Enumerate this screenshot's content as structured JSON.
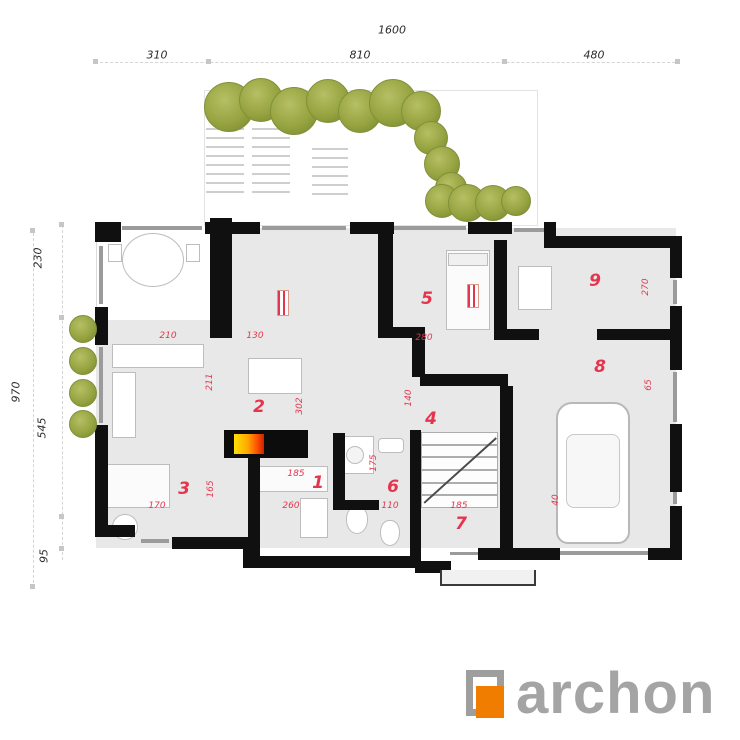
{
  "colors": {
    "floor": "#e8e8e8",
    "wall": "#101010",
    "red": "#e3364e",
    "logo_gray": "#a4a4a4",
    "logo_orange": "#f07d00",
    "green": "#97a441",
    "accent_green": "#5ec81e"
  },
  "logo": {
    "text": "archon"
  },
  "dimensions": {
    "top": [
      {
        "label": "1600",
        "x": 392,
        "y": 30
      },
      {
        "label": "310",
        "x": 157,
        "y": 55
      },
      {
        "label": "810",
        "x": 360,
        "y": 55
      },
      {
        "label": "480",
        "x": 594,
        "y": 55
      }
    ],
    "left": [
      {
        "label": "230",
        "x": 38,
        "y": 258
      },
      {
        "label": "970",
        "x": 16,
        "y": 392
      },
      {
        "label": "545",
        "x": 42,
        "y": 428
      },
      {
        "label": "95",
        "x": 44,
        "y": 556
      }
    ]
  },
  "rooms": [
    {
      "number": "1",
      "x": 318,
      "y": 483
    },
    {
      "number": "2",
      "x": 259,
      "y": 407
    },
    {
      "number": "3",
      "x": 184,
      "y": 489
    },
    {
      "number": "4",
      "x": 431,
      "y": 419
    },
    {
      "number": "5",
      "x": 427,
      "y": 299
    },
    {
      "number": "6",
      "x": 393,
      "y": 487
    },
    {
      "number": "7",
      "x": 461,
      "y": 524
    },
    {
      "number": "8",
      "x": 600,
      "y": 367
    },
    {
      "number": "9",
      "x": 595,
      "y": 281
    }
  ],
  "room_dims": [
    {
      "text": "210",
      "x": 168,
      "y": 336,
      "rot": false
    },
    {
      "text": "130",
      "x": 255,
      "y": 336,
      "rot": false
    },
    {
      "text": "211",
      "x": 210,
      "y": 382,
      "rot": true
    },
    {
      "text": "302",
      "x": 300,
      "y": 406,
      "rot": true
    },
    {
      "text": "170",
      "x": 157,
      "y": 506,
      "rot": false
    },
    {
      "text": "165",
      "x": 211,
      "y": 489,
      "rot": true
    },
    {
      "text": "185",
      "x": 296,
      "y": 474,
      "rot": false
    },
    {
      "text": "260",
      "x": 291,
      "y": 506,
      "rot": false
    },
    {
      "text": "140",
      "x": 409,
      "y": 398,
      "rot": true
    },
    {
      "text": "280",
      "x": 424,
      "y": 338,
      "rot": false
    },
    {
      "text": "110",
      "x": 390,
      "y": 506,
      "rot": false
    },
    {
      "text": "185",
      "x": 459,
      "y": 506,
      "rot": false
    },
    {
      "text": "175",
      "x": 374,
      "y": 463,
      "rot": true
    },
    {
      "text": "65",
      "x": 649,
      "y": 385,
      "rot": true
    },
    {
      "text": "270",
      "x": 646,
      "y": 287,
      "rot": true
    },
    {
      "text": "40",
      "x": 556,
      "y": 500,
      "rot": true
    }
  ],
  "geometry": {
    "floor": [
      [
        96,
        228,
        580,
        320
      ]
    ],
    "terrace": [
      [
        96,
        228,
        114,
        92
      ]
    ],
    "walls": [
      [
        95,
        222,
        26,
        20
      ],
      [
        205,
        222,
        55,
        12
      ],
      [
        350,
        222,
        44,
        12
      ],
      [
        468,
        222,
        44,
        12
      ],
      [
        544,
        222,
        12,
        26
      ],
      [
        554,
        236,
        128,
        12
      ],
      [
        670,
        236,
        12,
        42
      ],
      [
        670,
        306,
        12,
        64
      ],
      [
        670,
        424,
        12,
        68
      ],
      [
        670,
        506,
        12,
        54
      ],
      [
        95,
        307,
        13,
        38
      ],
      [
        95,
        425,
        13,
        112
      ],
      [
        95,
        525,
        40,
        12
      ],
      [
        172,
        537,
        83,
        12
      ],
      [
        243,
        537,
        12,
        31
      ],
      [
        255,
        556,
        82,
        12
      ],
      [
        337,
        556,
        81,
        12
      ],
      [
        415,
        561,
        36,
        12
      ],
      [
        478,
        548,
        52,
        12
      ],
      [
        528,
        548,
        32,
        12
      ],
      [
        648,
        548,
        34,
        12
      ],
      [
        210,
        218,
        22,
        120
      ],
      [
        378,
        222,
        15,
        110
      ],
      [
        378,
        327,
        47,
        11
      ],
      [
        412,
        330,
        13,
        47
      ],
      [
        420,
        374,
        88,
        12
      ],
      [
        494,
        240,
        13,
        100
      ],
      [
        507,
        329,
        32,
        11
      ],
      [
        597,
        329,
        73,
        11
      ],
      [
        500,
        386,
        13,
        162
      ],
      [
        410,
        430,
        11,
        131
      ],
      [
        333,
        433,
        12,
        72
      ],
      [
        333,
        500,
        46,
        10
      ],
      [
        248,
        458,
        12,
        99
      ]
    ],
    "windows": [
      [
        122,
        226,
        80,
        4
      ],
      [
        262,
        226,
        84,
        4
      ],
      [
        394,
        226,
        72,
        4
      ],
      [
        514,
        228,
        38,
        4
      ],
      [
        673,
        280,
        4,
        24
      ],
      [
        673,
        372,
        4,
        50
      ],
      [
        673,
        492,
        4,
        12
      ],
      [
        99,
        246,
        4,
        58
      ],
      [
        99,
        347,
        4,
        76
      ],
      [
        141,
        539,
        28,
        4
      ],
      [
        560,
        551,
        88,
        4
      ],
      [
        450,
        552,
        28,
        3
      ]
    ],
    "furniture": [
      {
        "type": "table-ellipse",
        "rect": [
          122,
          233,
          62,
          54
        ]
      },
      {
        "type": "chair",
        "rect": [
          108,
          244,
          14,
          18
        ]
      },
      {
        "type": "chair",
        "rect": [
          186,
          244,
          14,
          18
        ]
      },
      {
        "type": "counter",
        "rect": [
          112,
          344,
          92,
          24
        ]
      },
      {
        "type": "counter",
        "rect": [
          112,
          372,
          24,
          66
        ]
      },
      {
        "type": "table",
        "rect": [
          248,
          358,
          54,
          36
        ]
      },
      {
        "type": "bed",
        "rect": [
          102,
          464,
          68,
          44
        ]
      },
      {
        "type": "table-round",
        "rect": [
          112,
          514,
          26,
          26
        ]
      },
      {
        "type": "bed",
        "rect": [
          446,
          250,
          44,
          80
        ]
      },
      {
        "type": "pillow",
        "rect": [
          448,
          253,
          40,
          13
        ]
      },
      {
        "type": "fixture",
        "rect": [
          518,
          266,
          34,
          44
        ]
      },
      {
        "type": "sofa",
        "rect": [
          256,
          466,
          72,
          26
        ]
      },
      {
        "type": "table",
        "rect": [
          300,
          498,
          28,
          40
        ]
      },
      {
        "type": "shower",
        "rect": [
          336,
          436,
          38,
          38
        ]
      },
      {
        "type": "shower-head",
        "rect": [
          346,
          446,
          18,
          18
        ]
      },
      {
        "type": "sink",
        "rect": [
          378,
          438,
          26,
          15
        ]
      },
      {
        "type": "toilet",
        "rect": [
          346,
          506,
          22,
          28
        ]
      },
      {
        "type": "toilet",
        "rect": [
          380,
          520,
          20,
          26
        ]
      },
      {
        "type": "radiator",
        "rect": [
          277,
          290,
          12,
          26
        ]
      },
      {
        "type": "radiator",
        "rect": [
          467,
          284,
          12,
          24
        ]
      },
      {
        "type": "car-body",
        "rect": [
          556,
          402,
          74,
          142
        ]
      },
      {
        "type": "car-inner",
        "rect": [
          566,
          434,
          54,
          74
        ]
      },
      {
        "type": "accent",
        "rect": [
          281,
          102,
          12,
          12
        ]
      }
    ],
    "pergola": [
      [
        206,
        128,
        38,
        72
      ],
      [
        252,
        128,
        38,
        72
      ],
      [
        312,
        148,
        36,
        52
      ]
    ],
    "terrace_outline": [
      [
        204,
        90,
        332,
        134
      ]
    ],
    "porch": [
      440,
      570,
      92,
      14
    ],
    "bushes": [
      [
        228,
        106,
        24
      ],
      [
        260,
        99,
        21
      ],
      [
        293,
        110,
        23
      ],
      [
        327,
        100,
        21
      ],
      [
        359,
        110,
        21
      ],
      [
        392,
        102,
        23
      ],
      [
        420,
        110,
        19
      ],
      [
        430,
        137,
        16
      ],
      [
        441,
        163,
        17
      ],
      [
        450,
        187,
        15
      ],
      [
        441,
        200,
        16
      ],
      [
        466,
        202,
        18
      ],
      [
        492,
        202,
        17
      ],
      [
        515,
        200,
        14
      ],
      [
        82,
        328,
        13
      ],
      [
        82,
        360,
        13
      ],
      [
        82,
        392,
        13
      ],
      [
        82,
        423,
        13
      ]
    ],
    "fireplace": {
      "base": [
        224,
        430,
        84,
        28
      ],
      "flame": [
        234,
        434,
        30,
        20
      ]
    },
    "stairs": {
      "x": 421,
      "y": 432,
      "w": 77,
      "h": 76,
      "steps": 6
    },
    "dash_h": [
      [
        95,
        62,
        585
      ]
    ],
    "dash_v": [
      [
        62,
        225,
        335
      ],
      [
        33,
        228,
        360
      ]
    ],
    "ticks": [
      [
        93,
        59
      ],
      [
        206,
        59
      ],
      [
        502,
        59
      ],
      [
        675,
        59
      ],
      [
        59,
        222
      ],
      [
        59,
        315
      ],
      [
        59,
        514
      ],
      [
        59,
        546
      ],
      [
        30,
        228
      ],
      [
        30,
        584
      ]
    ]
  }
}
